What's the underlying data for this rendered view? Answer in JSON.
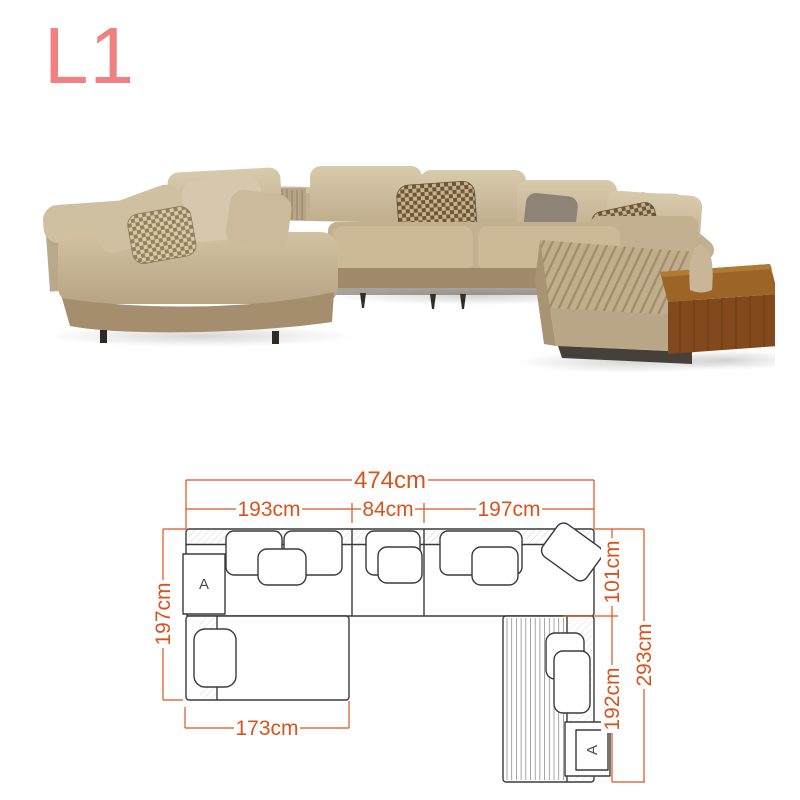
{
  "page": {
    "background": "#ffffff",
    "variant_label": "L1"
  },
  "colors": {
    "variant_label": "#ef8181",
    "dimension_lines": "#d9531e",
    "diagram_outline": "#3a3a3a",
    "sofa_fabric": "#c4b191",
    "sofa_fabric_light": "#d6c8ab",
    "sofa_fabric_dark": "#a48e6e",
    "houndstooth_dark": "#6b573c",
    "wood_table": "#9c6527",
    "base_plinth": "#46403a"
  },
  "product": {
    "type": "l-shaped-sectional-sofa",
    "description": "Beige boucle corner sectional sofa with left chaise, channel-stitched ottoman bench and attached walnut side table with vase"
  },
  "diagram": {
    "unit": "cm",
    "armrest_marker": "A",
    "dimensions": {
      "total_width": "474cm",
      "left_section_width": "193cm",
      "middle_section_width": "84cm",
      "right_section_width": "197cm",
      "left_total_depth": "197cm",
      "left_chaise_width": "173cm",
      "right_upper_depth": "101cm",
      "right_lower_depth": "192cm",
      "right_total_depth": "293cm"
    },
    "values": {
      "total_width_cm": 474,
      "left_section_cm": 193,
      "middle_section_cm": 84,
      "right_section_cm": 197,
      "left_depth_cm": 197,
      "left_chaise_cm": 173,
      "right_upper_cm": 101,
      "right_lower_cm": 192,
      "right_total_cm": 293
    }
  }
}
